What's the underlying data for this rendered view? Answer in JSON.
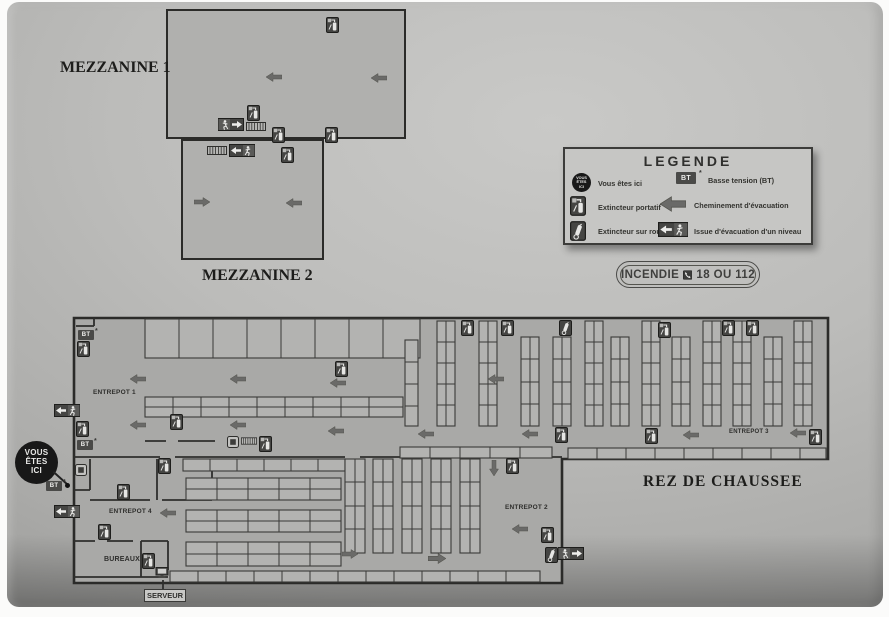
{
  "floors": {
    "mezzanine1": "MEZZANINE 1",
    "mezzanine2": "MEZZANINE 2",
    "ground_floor": "REZ DE CHAUSSEE"
  },
  "rooms": {
    "entrepot1": "ENTREPOT 1",
    "entrepot2": "ENTREPOT 2",
    "entrepot3": "ENTREPOT 3",
    "entrepot4": "ENTREPOT 4",
    "bureaux": "BUREAUX",
    "serveur": "SERVEUR"
  },
  "legend": {
    "title": "LEGENDE",
    "rows_left": [
      {
        "icon": "you-are-here-marker",
        "label": "Vous êtes ici"
      },
      {
        "icon": "extinguisher-portable-icon",
        "label": "Extincteur portatif"
      },
      {
        "icon": "extinguisher-wheeled-icon",
        "label": "Extincteur sur roues"
      }
    ],
    "rows_right": [
      {
        "icon": "bt-badge",
        "label": "Basse tension (BT)"
      },
      {
        "icon": "evacuation-arrow-icon",
        "label": "Cheminement d'évacuation"
      },
      {
        "icon": "level-exit-icon",
        "label": "Issue d'évacuation d'un niveau"
      }
    ]
  },
  "emergency_badge": {
    "label": "INCENDIE",
    "phone_icon": "phone-icon",
    "numbers": "18 OU 112"
  },
  "you_are_here_marker": "VOUS\nÊTES\nICI",
  "bt_label": "BT",
  "bt_note": "*",
  "colors": {
    "board_gray": "#b5b5b3",
    "plan_fill": "#a9a9a7",
    "wall_ink": "#2f2f2d",
    "icon_dark": "#454543",
    "arrow_gray": "#6a6a68",
    "marker_black": "#181818"
  }
}
